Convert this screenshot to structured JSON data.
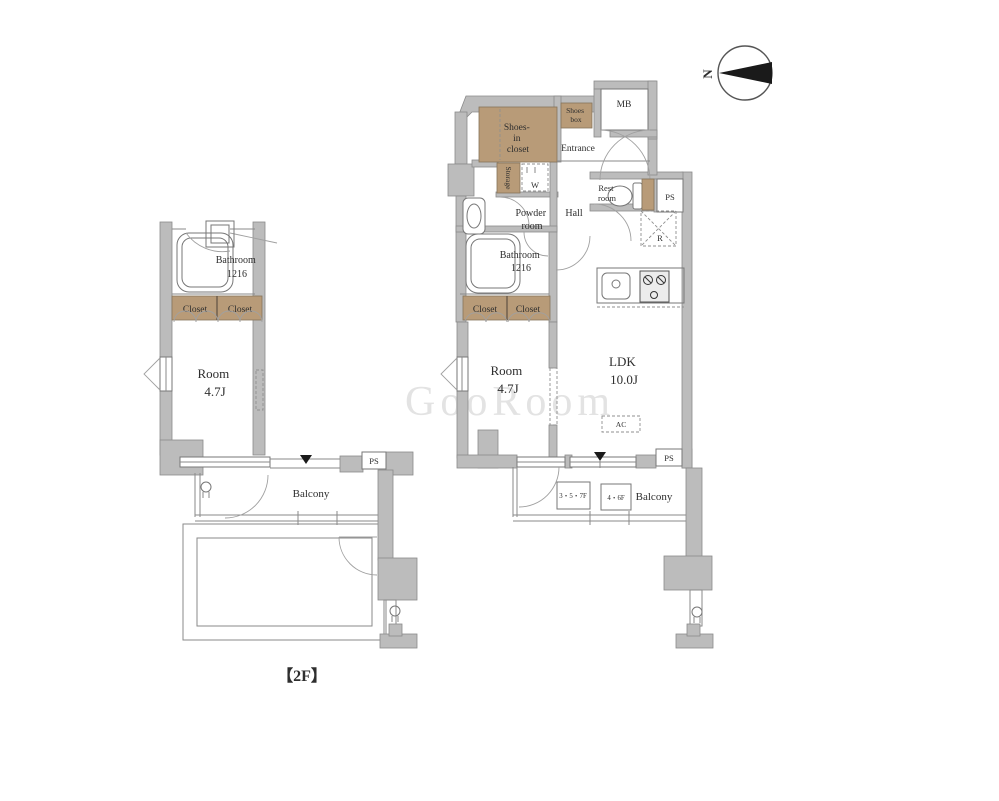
{
  "floor_plan": {
    "floor_label": "【2F】",
    "compass": {
      "letter": "N"
    },
    "watermark": "GooRoom",
    "colors": {
      "wall": "#bcbcbc",
      "closet_fill": "#b89b78",
      "line": "#8a8a8a",
      "text": "#2e2e2e"
    },
    "left_unit": {
      "bathroom_l1": "Bathroom",
      "bathroom_l2": "1216",
      "closet_a": "Closet",
      "closet_b": "Closet",
      "room_l1": "Room",
      "room_l2": "4.7J",
      "balcony": "Balcony",
      "ps": "PS"
    },
    "right_unit": {
      "shoes_in_closet_l1": "Shoes-",
      "shoes_in_closet_l2": "in",
      "shoes_in_closet_l3": "closet",
      "shoes_box_l1": "Shoes",
      "shoes_box_l2": "box",
      "mb": "MB",
      "entrance": "Entrance",
      "storage": "Storage",
      "washer": "W",
      "restroom_l1": "Rest",
      "restroom_l2": "room",
      "ps_top": "PS",
      "powder_l1": "Powder",
      "powder_l2": "room",
      "hall": "Hall",
      "fridge": "R",
      "bathroom_l1": "Bathroom",
      "bathroom_l2": "1216",
      "closet_a": "Closet",
      "closet_b": "Closet",
      "room_l1": "Room",
      "room_l2": "4.7J",
      "ldk_l1": "LDK",
      "ldk_l2": "10.0J",
      "ac": "AC",
      "balcony": "Balcony",
      "floors_a": "3・5・7F",
      "floors_b": "4・6F",
      "ps_bottom": "PS"
    }
  }
}
